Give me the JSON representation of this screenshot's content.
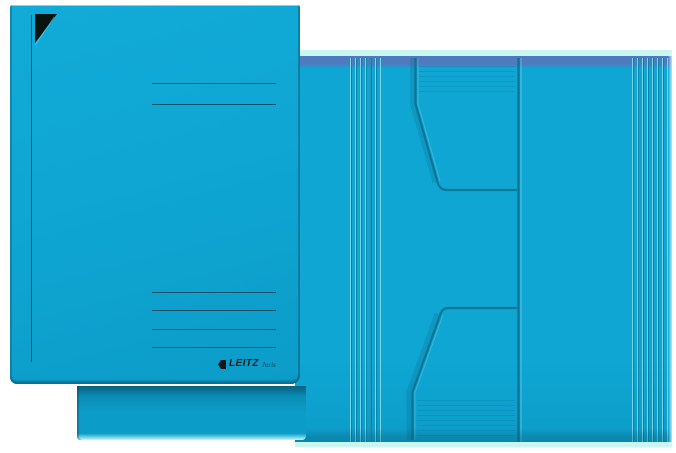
{
  "product": {
    "description": "blue trifold cardboard folder, closed front view and opened view"
  },
  "brand": {
    "logo_text": "LEITZ",
    "logo_sub": "Juris"
  },
  "colors": {
    "page-bg": "#ffffff",
    "folder-blue": "#0fa6d4",
    "folder-blue-deep": "#0c9cc8",
    "folder-blue-dark": "#0a8db6",
    "edge-teal": "#0b7595",
    "edge-teal-dark": "#09607c",
    "rule-line": "#113c4e",
    "top-band": "#4e7bc0",
    "edge-highlight": "#c9f6f1",
    "score-light": "#74d7e8",
    "score-dark": "#0c84a8",
    "corner-black": "#08140f",
    "logo-black": "#14181b"
  },
  "left_folder": {
    "origin": [
      10,
      5
    ],
    "top_lines_y": [
      83,
      104
    ],
    "bottom_lines_y": [
      292,
      310,
      329,
      347
    ],
    "lines_x": [
      152,
      276
    ],
    "vertical_line": {
      "x": 31,
      "y1": 15,
      "y2": 362
    }
  },
  "right_folder": {
    "origin": [
      295,
      50
    ],
    "score_groups": [
      {
        "x": 350,
        "count": 6,
        "spacing": 5
      },
      {
        "x": 632,
        "count": 7,
        "spacing": 5
      }
    ],
    "strong_score_x": 370,
    "fold_x": 518
  }
}
